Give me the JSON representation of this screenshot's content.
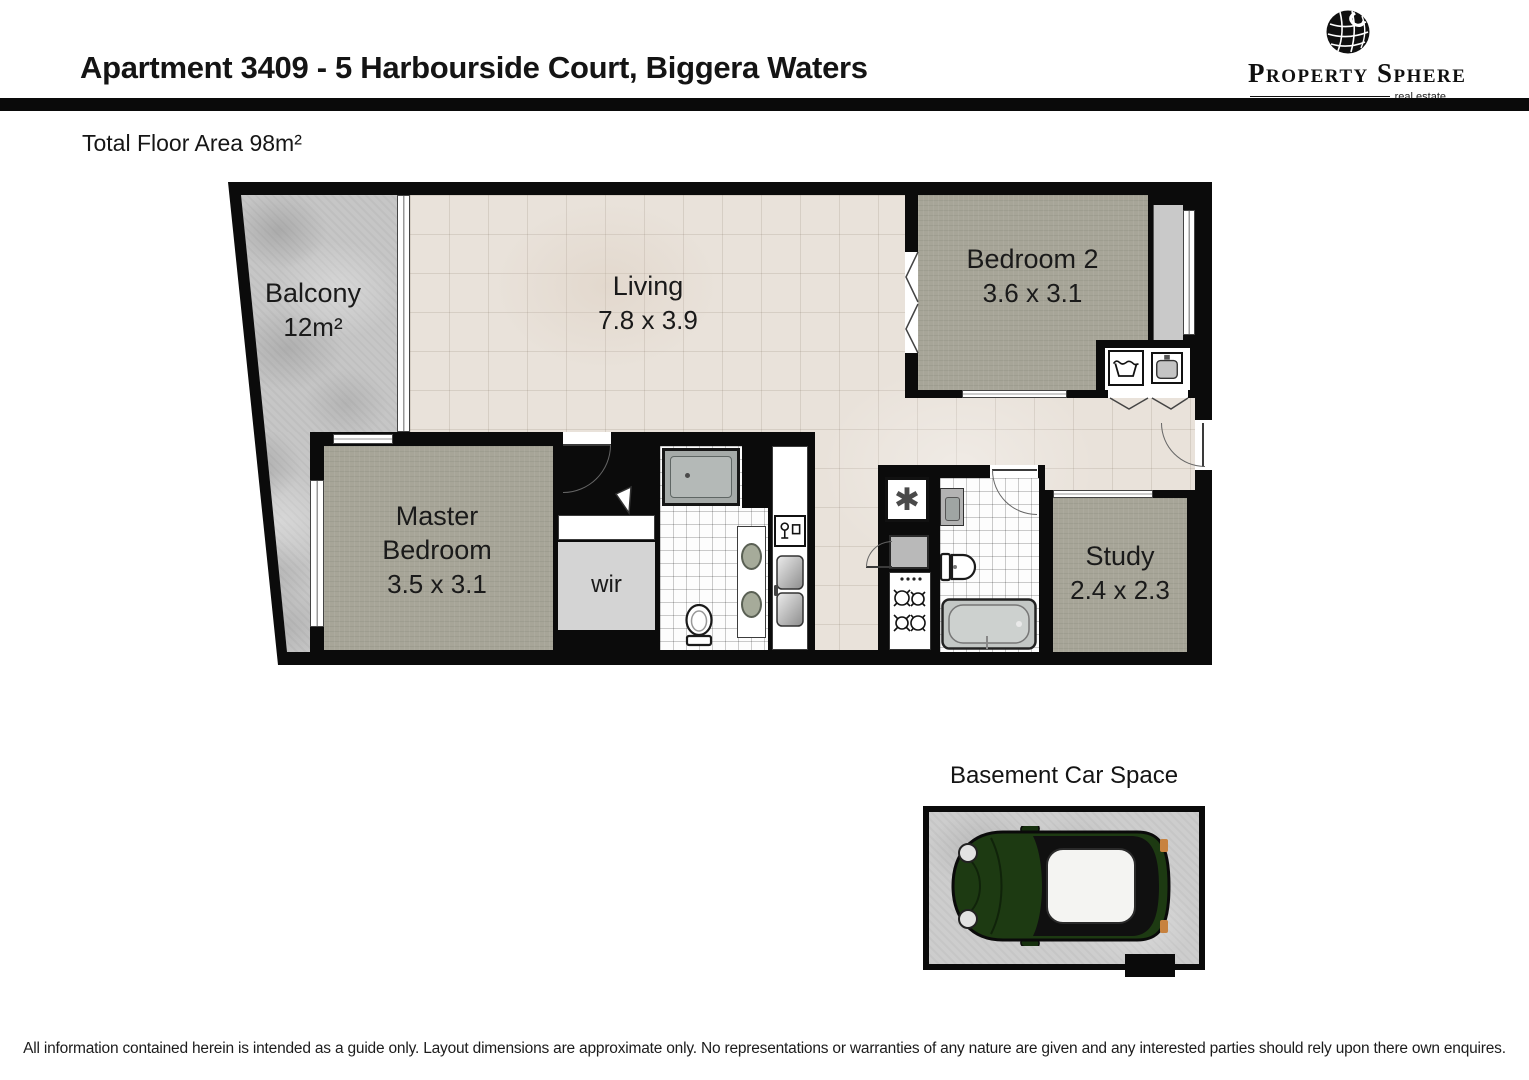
{
  "header": {
    "title": "Apartment 3409 - 5 Harbourside Court, Biggera Waters",
    "logo": {
      "wordmark": "Property Sphere",
      "tagline": "real estate"
    }
  },
  "floor_area_label": "Total Floor Area 98m²",
  "floor_plan": {
    "balcony": {
      "label": "Balcony",
      "size": "12m²"
    },
    "living": {
      "label": "Living",
      "size": "7.8 x 3.9"
    },
    "bedroom2": {
      "label": "Bedroom 2",
      "size": "3.6 x 3.1"
    },
    "master_bedroom": {
      "label": "Master Bedroom",
      "size": "3.5 x 3.1"
    },
    "wir": {
      "label": "wir"
    },
    "study": {
      "label": "Study",
      "size": "2.4 x 2.3"
    }
  },
  "car_space": {
    "title": "Basement Car Space"
  },
  "disclaimer": "All information contained herein is intended as a guide only. Layout dimensions are approximate only. No representations or warranties of any nature are given and any interested parties should rely upon there own enquires.",
  "icons": {
    "hot_water_unit": "✱"
  },
  "colors": {
    "wall": "#0b0b0b",
    "floor_tile": "#e9e2da",
    "carpet": "#a7a598",
    "concrete": "#c6c6c6",
    "car_body": "#1d3a12"
  }
}
